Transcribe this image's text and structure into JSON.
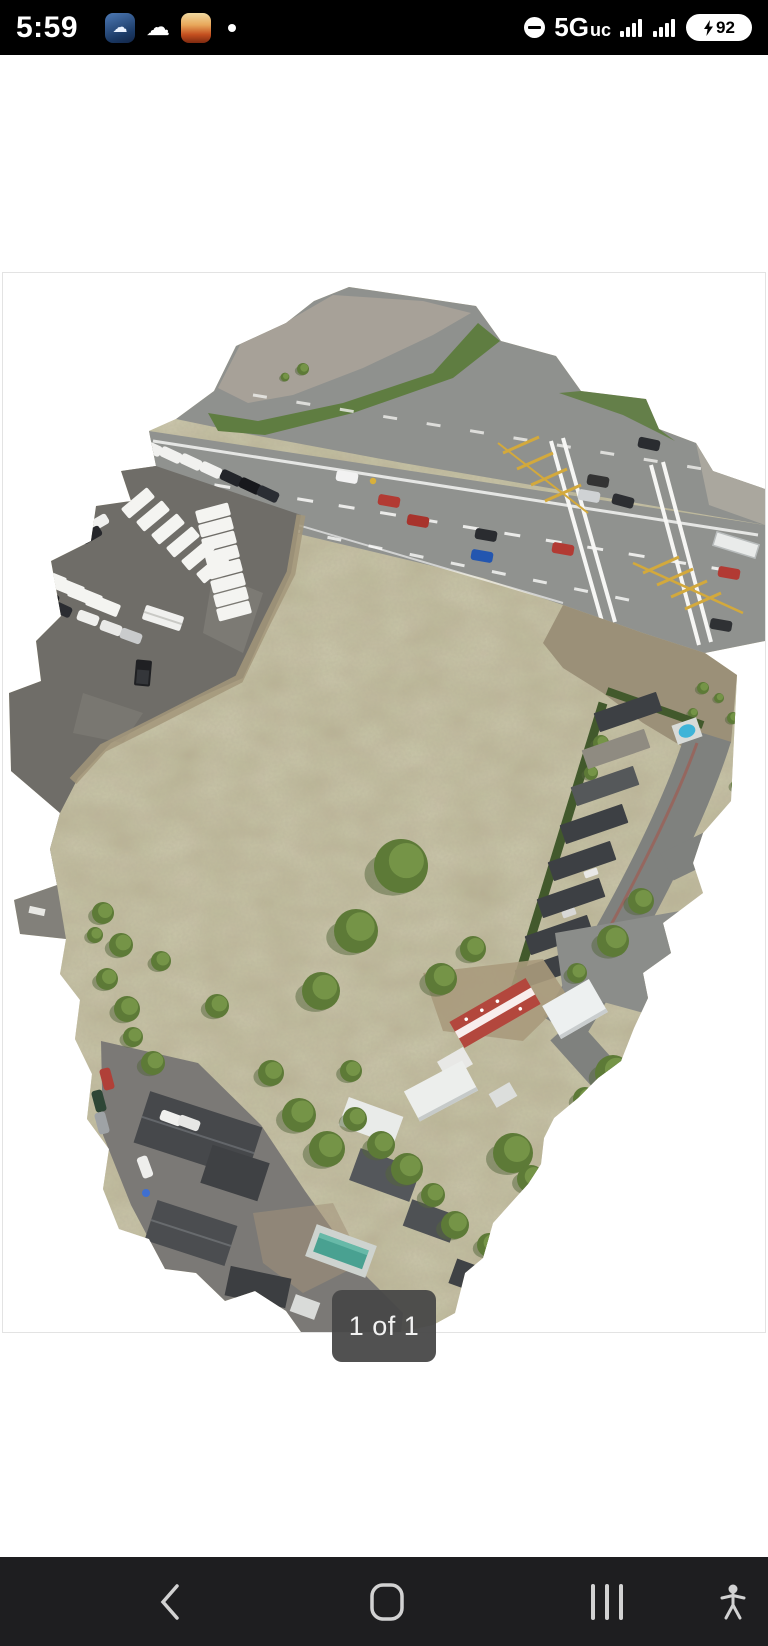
{
  "status_bar": {
    "time": "5:59",
    "network": "5G",
    "network_suffix": "uc",
    "battery_percent": "92",
    "icons": {
      "left": [
        "weather-app-icon",
        "cloud-app-icon",
        "gallery-app-icon",
        "notification-overflow-dot"
      ],
      "right": [
        "do-not-disturb-icon",
        "cellular-signal-icon",
        "secondary-signal-icon",
        "battery-charging-icon"
      ]
    }
  },
  "photo_viewer": {
    "pager_label": "1 of 1"
  },
  "nav_bar": {
    "buttons": [
      "back",
      "home",
      "recents",
      "accessibility"
    ]
  }
}
